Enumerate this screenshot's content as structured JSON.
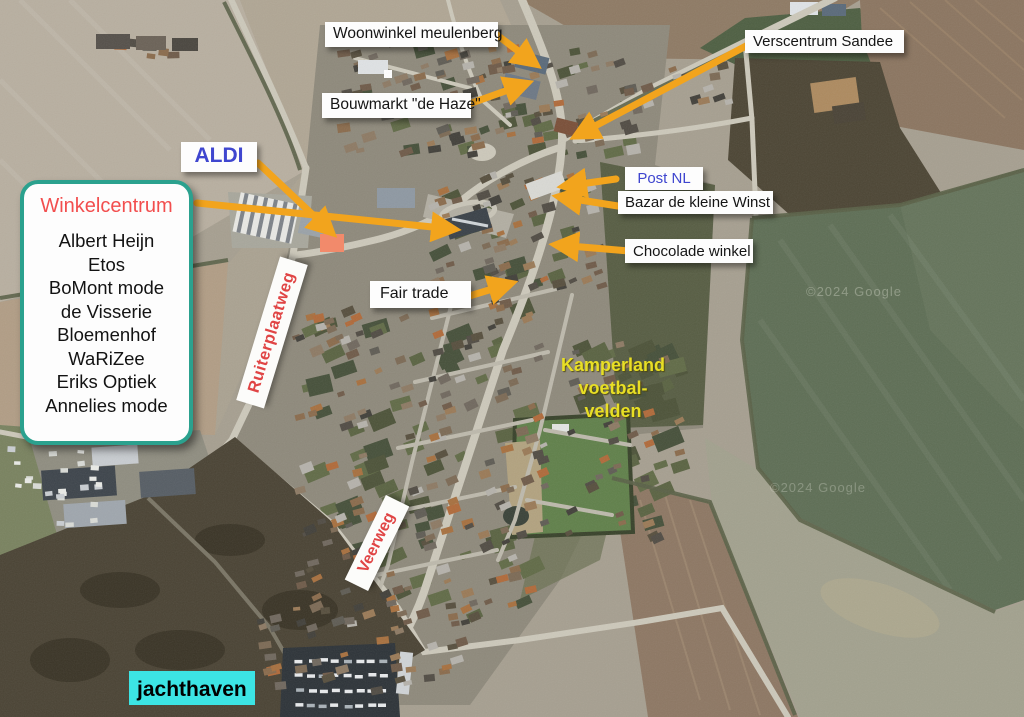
{
  "colors": {
    "arrow": "#f2a41d",
    "marker": "#f28a6b",
    "blue_label": "#3f46cf",
    "red_label": "#f24e4e",
    "street_red": "#e04545",
    "yellow_label": "#e8df25",
    "cyan_bg": "#3ce4e4",
    "box_border_green": "#2ba18e"
  },
  "labels": {
    "woonwinkel": "Woonwinkel meulenberg",
    "bouwmarkt": "Bouwmarkt \"de Haze\"",
    "verscentrum": "Verscentrum Sandee",
    "aldi": "ALDI",
    "postnl": "Post NL",
    "bazar": "Bazar de kleine Winst",
    "chocolade": "Chocolade winkel",
    "fairtrade": "Fair trade",
    "jachthaven": "jachthaven",
    "ruiterplaatweg": "Ruiterplaatweg",
    "veerweg": "Veerweg",
    "kamperland_lines": [
      "Kamperland",
      "voetbal-",
      "velden"
    ]
  },
  "winkelcentrum": {
    "title": "Winkelcentrum",
    "shops": [
      "Albert Heijn",
      "Etos",
      "BoMont mode",
      "de Visserie",
      "Bloemenhof",
      "WaRiZee",
      "Eriks Optiek",
      "Annelies mode"
    ]
  },
  "watermarks": [
    "©2024 Google",
    "©2024 Google"
  ]
}
